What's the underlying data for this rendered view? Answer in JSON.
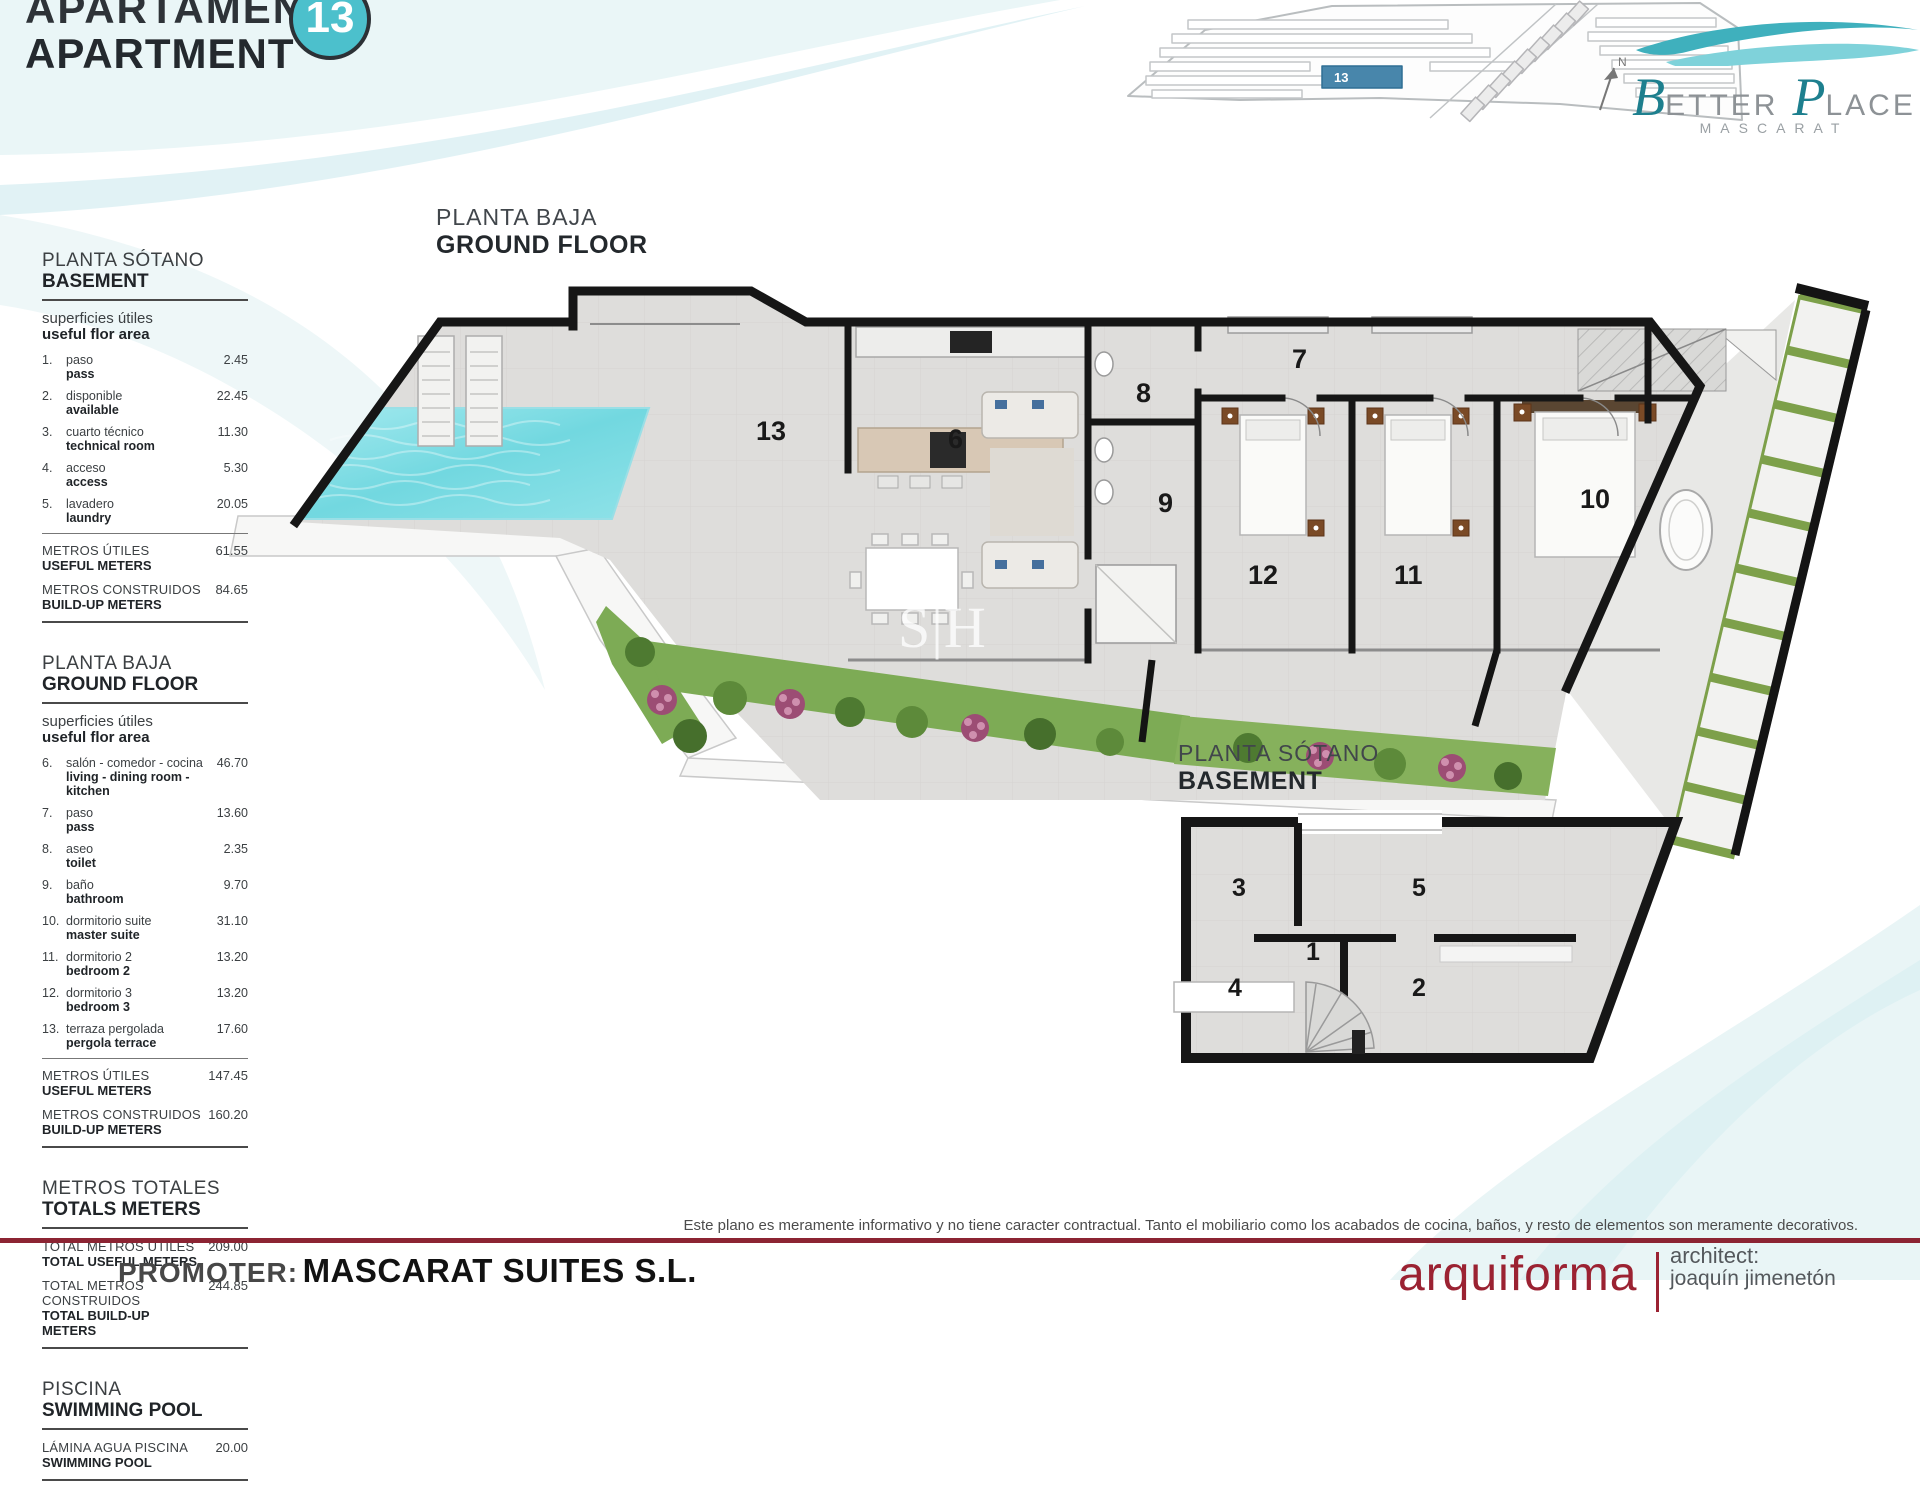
{
  "header": {
    "title_es": "APARTAMENTO",
    "title_en": "APARTMENT",
    "unit_badge": "13",
    "badge_color": "#4cc0cc"
  },
  "brand": {
    "b": "B",
    "etter": "ETTER",
    "p": "P",
    "lace": "LACE",
    "subtitle": "MASCARAT",
    "teal": "#1d7f8e"
  },
  "keyplan": {
    "unit_label": "13",
    "highlight_color": "#4886ab",
    "compass": "N"
  },
  "plans": {
    "ground": {
      "title_es": "PLANTA BAJA",
      "title_en": "GROUND FLOOR",
      "labels": [
        "13",
        "6",
        "7",
        "8",
        "9",
        "12",
        "11",
        "10"
      ]
    },
    "basement": {
      "title_es": "PLANTA SÓTANO",
      "title_en": "BASEMENT",
      "labels": [
        "3",
        "5",
        "1",
        "4",
        "2"
      ]
    },
    "watermark": "S|H"
  },
  "sidebar": {
    "sections": [
      {
        "title_es": "PLANTA SÓTANO",
        "title_en": "BASEMENT",
        "sub_es": "superficies útiles",
        "sub_en": "useful flor area",
        "items": [
          {
            "num": "1.",
            "es": "paso",
            "en": "pass",
            "val": "2.45"
          },
          {
            "num": "2.",
            "es": "disponible",
            "en": "available",
            "val": "22.45"
          },
          {
            "num": "3.",
            "es": "cuarto técnico",
            "en": "technical room",
            "val": "11.30"
          },
          {
            "num": "4.",
            "es": "acceso",
            "en": "access",
            "val": "5.30"
          },
          {
            "num": "5.",
            "es": "lavadero",
            "en": "laundry",
            "val": "20.05"
          }
        ],
        "totals": [
          {
            "es": "METROS ÚTILES",
            "en": "USEFUL METERS",
            "val": "61.55"
          },
          {
            "es": "METROS CONSTRUIDOS",
            "en": "BUILD-UP METERS",
            "val": "84.65"
          }
        ]
      },
      {
        "title_es": "PLANTA BAJA",
        "title_en": "GROUND FLOOR",
        "sub_es": "superficies útiles",
        "sub_en": "useful flor area",
        "items": [
          {
            "num": "6.",
            "es": "salón - comedor - cocina",
            "en": "living - dining room - kitchen",
            "val": "46.70"
          },
          {
            "num": "7.",
            "es": "paso",
            "en": "pass",
            "val": "13.60"
          },
          {
            "num": "8.",
            "es": "aseo",
            "en": "toilet",
            "val": "2.35"
          },
          {
            "num": "9.",
            "es": "baño",
            "en": "bathroom",
            "val": "9.70"
          },
          {
            "num": "10.",
            "es": "dormitorio suite",
            "en": "master suite",
            "val": "31.10"
          },
          {
            "num": "11.",
            "es": "dormitorio 2",
            "en": "bedroom 2",
            "val": "13.20"
          },
          {
            "num": "12.",
            "es": "dormitorio 3",
            "en": "bedroom 3",
            "val": "13.20"
          },
          {
            "num": "13.",
            "es": "terraza pergolada",
            "en": "pergola terrace",
            "val": "17.60"
          }
        ],
        "totals": [
          {
            "es": "METROS ÚTILES",
            "en": "USEFUL METERS",
            "val": "147.45"
          },
          {
            "es": "METROS CONSTRUIDOS",
            "en": "BUILD-UP METERS",
            "val": "160.20"
          }
        ]
      },
      {
        "title_es": "METROS TOTALES",
        "title_en": "TOTALS METERS",
        "totals": [
          {
            "es": "TOTAL METROS ÚTILES",
            "en": "TOTAL USEFUL METERS",
            "val": "209.00"
          },
          {
            "es": "TOTAL METROS CONSTRUIDOS",
            "en": "TOTAL BUILD-UP METERS",
            "val": "244.85"
          }
        ]
      },
      {
        "title_es": "PISCINA",
        "title_en": "SWIMMING POOL",
        "totals": [
          {
            "es": "LÁMINA AGUA PISCINA",
            "en": "SWIMMING POOL",
            "val": "20.00"
          }
        ]
      }
    ]
  },
  "footer": {
    "disclaimer": "Este plano es meramente informativo y no tiene caracter contractual. Tanto el mobiliario como los acabados de cocina, baños, y resto de elementos son meramente decorativos.",
    "promoter_label": "PROMOTER:",
    "promoter_name": "MASCARAT SUITES S.L.",
    "studio": "arquiforma",
    "architect_label": "architect:",
    "architect_name": "joaquín jimenetón",
    "line_color": "#8c2433"
  }
}
